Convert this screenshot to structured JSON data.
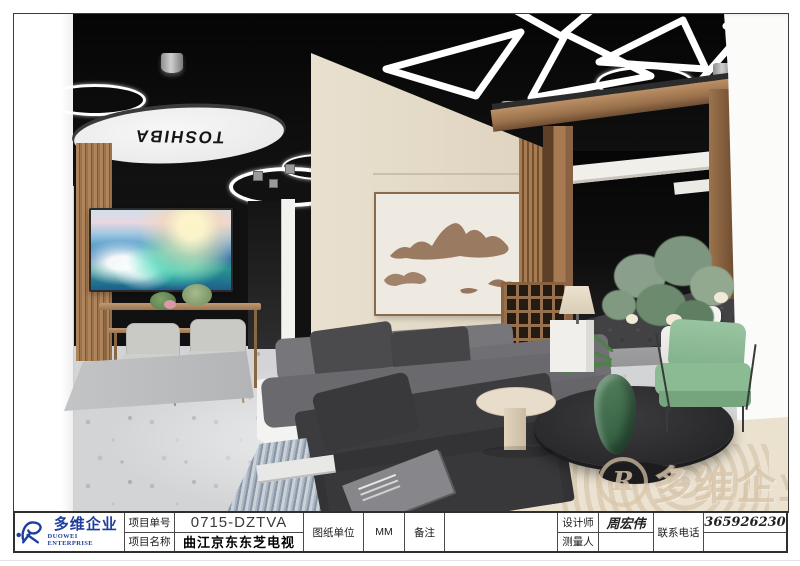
{
  "scene": {
    "toshiba_sign": "TOSHIBA",
    "watermark_text": "多维企业",
    "watermark_mark": "R"
  },
  "title_block": {
    "logo": {
      "mark": "R",
      "name_cn": "多维企业",
      "name_en": "DUOWEI ENTERPRISE"
    },
    "project_no_label": "项目单号",
    "project_no_value": "0715-DZTVA",
    "project_name_label": "项目名称",
    "project_name_value": "曲江京东东芝电视",
    "unit_label": "图纸单位",
    "unit_value": "MM",
    "remarks_label": "备注",
    "remarks_value": "",
    "designer_label": "设计师",
    "designer_value": "周宏伟",
    "surveyor_label": "测量人",
    "surveyor_value": "",
    "phone_label": "联系电话",
    "phone_value": "13659262305"
  },
  "colors": {
    "logo_blue": "#1e3e9d",
    "ceiling_black": "#0a0a0a",
    "wood": "#a87a52",
    "wall_cream": "#e8e0d2",
    "sofa_gray": "#6a6a6e",
    "chair_green": "#8abb93",
    "floor_terrazzo": "#d3d4d6"
  }
}
